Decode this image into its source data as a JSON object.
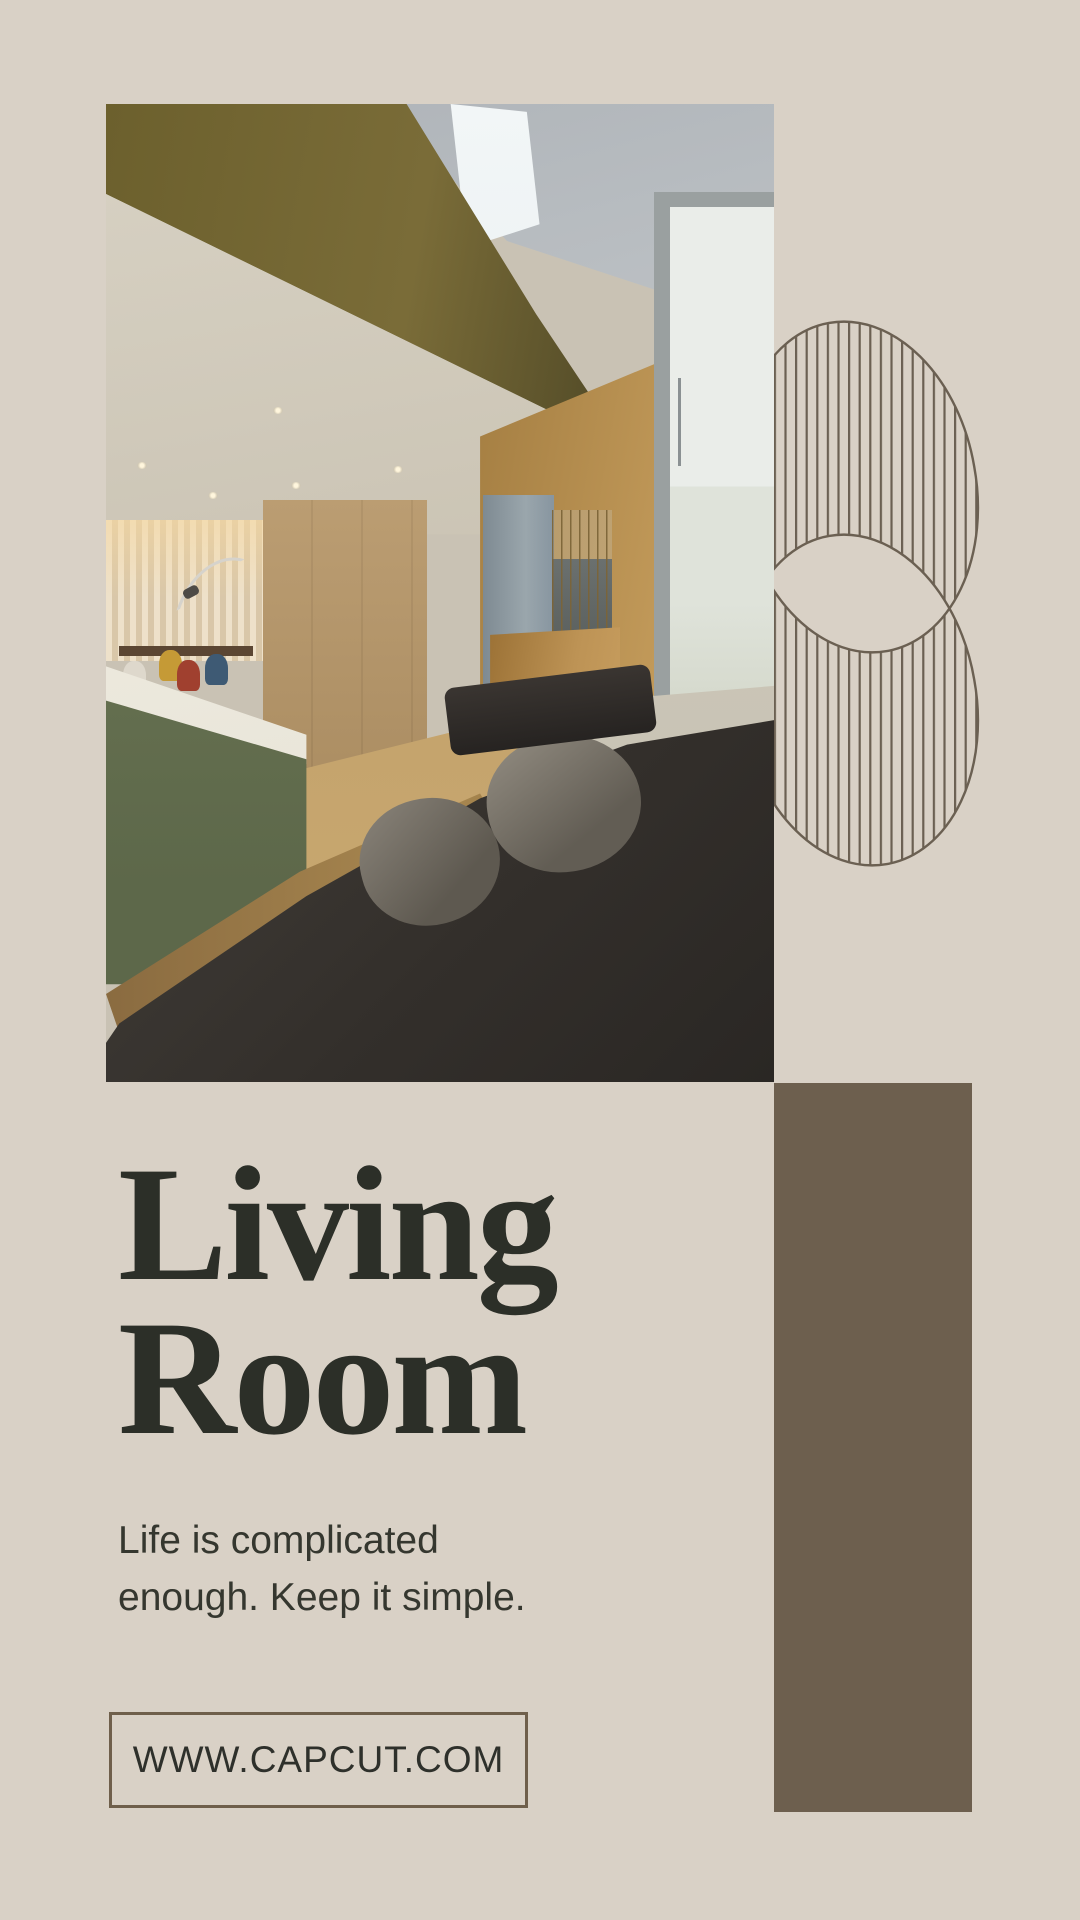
{
  "poster": {
    "background_color": "#D9D1C6",
    "title": {
      "line1": "Living",
      "line2": "Room",
      "color": "#2C2F28"
    },
    "subtitle": {
      "line1": "Life is complicated",
      "line2": "enough. Keep it simple.",
      "color": "#35372F"
    },
    "website_box": {
      "label": "WWW.CAPCUT.COM",
      "border_color": "#6F5F4B",
      "text_color": "#2E302B"
    },
    "accent_rectangle": {
      "color": "#6D5F4E"
    },
    "decoration": {
      "line_color": "#6B6052"
    },
    "photo": {
      "description": "Modern loft interior with olive mezzanine beam, skylight, cream curtains, dining set, green kitchen island, wood floor, dark leather sofa and glass door"
    }
  }
}
